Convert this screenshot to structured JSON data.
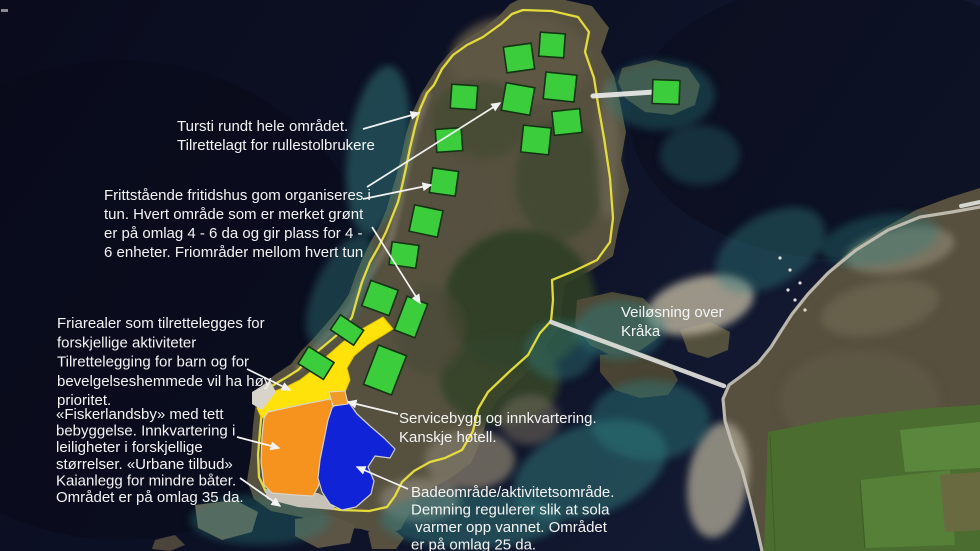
{
  "map_title": "Utviklingsplan – flyfoto med påtegninger",
  "colors": {
    "tun_green": "#3bcd3b",
    "tun_border": "#143214",
    "friareal_yellow": "#ffe20a",
    "friareal_yellow_border": "#e3c400",
    "fiskerlandsby_orange": "#f6921e",
    "badeomrade_blue": "#1023d6",
    "servicebygg_orange": "#f09a28",
    "zone_edge_gray": "#d9d4c8",
    "kai_gray": "#c6c2b8",
    "tursti_outline_yellow": "#ece23c",
    "annotation_white": "#f2f2f2"
  },
  "typography": {
    "font_size": 15,
    "default_line_height": 19
  },
  "labels": [
    {
      "id": "tursti",
      "x": 177,
      "y": 131,
      "lh": 19,
      "lines": [
        "Tursti rundt hele området.",
        "Tilrettelagt for rullestolbrukere"
      ]
    },
    {
      "id": "fritidshus",
      "x": 104,
      "y": 200,
      "lh": 19,
      "lines": [
        "Frittstående fritidshus gom organiseres i",
        "tun.  Hvert område som er merket grønt",
        "er på omlag 4 - 6  da og gir plass for 4 -",
        "6 enheter.  Friområder mellom hvert tun"
      ]
    },
    {
      "id": "friarealer",
      "x": 57,
      "y": 328,
      "lh": 19.3,
      "lines": [
        "Friarealer som tilrettelegges for",
        "forskjellige aktiviteter",
        "Tilrettelegging for barn og for",
        "bevelgelseshemmede vil ha høy",
        "prioritet."
      ]
    },
    {
      "id": "fiskerlandsby",
      "x": 56,
      "y": 419,
      "lh": 16.6,
      "lines": [
        "«Fiskerlandsby» med tett",
        "bebyggelse. Innkvartering i",
        "leiligheter i forskjellige",
        "størrelser.  «Urbane tilbud»",
        "Kaianlegg for mindre båter.",
        "Området er på omlag 35 da."
      ]
    },
    {
      "id": "servicebygg",
      "x": 399,
      "y": 423,
      "lh": 19,
      "lines": [
        "Servicebygg og innkvartering.",
        "Kanskje hotell."
      ]
    },
    {
      "id": "badeomrade",
      "x": 411,
      "y": 497,
      "lh": 17.5,
      "lines": [
        "Badeområde/aktivitetsområde.",
        "Demning regulerer slik at sola",
        " varmer opp vannet.  Området",
        "er på omlag 25 da."
      ]
    },
    {
      "id": "veilosning",
      "x": 621,
      "y": 317,
      "lh": 19,
      "lines": [
        "Veiløsning over",
        "Kråka"
      ]
    }
  ],
  "green_tun_areas": [
    {
      "cx": 519,
      "cy": 58,
      "w": 28,
      "h": 26,
      "rot": -8
    },
    {
      "cx": 552,
      "cy": 45,
      "w": 25,
      "h": 24,
      "rot": 4
    },
    {
      "cx": 560,
      "cy": 87,
      "w": 31,
      "h": 27,
      "rot": 6
    },
    {
      "cx": 518,
      "cy": 99,
      "w": 29,
      "h": 28,
      "rot": 10
    },
    {
      "cx": 464,
      "cy": 97,
      "w": 26,
      "h": 24,
      "rot": 4
    },
    {
      "cx": 567,
      "cy": 122,
      "w": 28,
      "h": 24,
      "rot": -6
    },
    {
      "cx": 536,
      "cy": 140,
      "w": 28,
      "h": 27,
      "rot": 6
    },
    {
      "cx": 449,
      "cy": 140,
      "w": 26,
      "h": 23,
      "rot": -4
    },
    {
      "cx": 444,
      "cy": 182,
      "w": 26,
      "h": 25,
      "rot": 8
    },
    {
      "cx": 426,
      "cy": 221,
      "w": 29,
      "h": 27,
      "rot": 12
    },
    {
      "cx": 404,
      "cy": 255,
      "w": 27,
      "h": 23,
      "rot": 8
    },
    {
      "cx": 666,
      "cy": 92,
      "w": 27,
      "h": 24,
      "rot": 2
    },
    {
      "cx": 380,
      "cy": 298,
      "w": 29,
      "h": 27,
      "rot": 20
    },
    {
      "cx": 347,
      "cy": 330,
      "w": 28,
      "h": 18,
      "rot": 34
    },
    {
      "cx": 316,
      "cy": 363,
      "w": 30,
      "h": 20,
      "rot": 32
    },
    {
      "cx": 411,
      "cy": 317,
      "w": 22,
      "h": 36,
      "rot": 21
    },
    {
      "cx": 385,
      "cy": 370,
      "w": 30,
      "h": 42,
      "rot": 21
    }
  ],
  "zones": [
    {
      "id": "friareal-yellow",
      "fill": "#ffe20a",
      "stroke": "#e3c400",
      "sw": 1,
      "points": "383,317 393,329 382,336 367,345 354,356 347,368 350,380 345,392 330,400 300,409 272,421 261,417 257,408 262,398 272,392 286,387 300,380 313,370 327,356 343,342 362,329"
    },
    {
      "id": "beach-wedge",
      "fill": "#d8d4c9",
      "stroke": "none",
      "sw": 0,
      "points": "252,392 270,381 276,392 262,410 252,404"
    },
    {
      "id": "kai-dock-gray",
      "fill": "#c6c2b8",
      "stroke": "none",
      "sw": 0,
      "points": "265,489 318,493 336,502 334,510 298,507 267,499"
    },
    {
      "id": "fiskerlandsby-orange",
      "fill": "#f6921e",
      "stroke": "#d9d4c8",
      "sw": 1.2,
      "points": "268,412 300,405 330,399 337,404 338,418 336,438 331,456 323,472 318,487 313,496 295,495 272,493 264,485 261,462 262,436 264,418"
    },
    {
      "id": "badeomrade-blue",
      "fill": "#1023d6",
      "stroke": "#cfcfcf",
      "sw": 1.2,
      "points": "336,404 347,400 357,414 370,426 384,438 395,449 390,458 375,456 368,467 374,481 371,494 356,507 342,510 330,504 322,492 318,478 320,460 324,440 328,420 332,408"
    },
    {
      "id": "servicebygg-orange-small",
      "fill": "#f09a28",
      "stroke": "#e0dcd2",
      "sw": 1,
      "points": "329,392 345,391 348,404 333,406"
    }
  ],
  "tursti_route": {
    "points": "523,10 552,11 578,17 589,32 585,52 594,78 598,104 604,138 610,178 613,218 610,242 597,260 574,271 552,280 553,300 551,321 540,333 528,355 509,372 488,392 478,409 473,431 462,450 445,458 430,462 414,471 402,482 395,496 387,507 369,511 341,510 315,506 282,501 266,492 259,477 258,455 260,431 262,409 258,400 265,391 275,384 287,377 298,370 308,360 319,350 331,340 344,329 352,317 357,299 362,282 370,262 378,248 386,232 392,217 398,202 402,186 406,168 410,148 415,127 420,109 427,93 434,85 442,69 453,55 467,45 483,37 501,24 512,14"
  },
  "link_lines": [
    {
      "id": "bridge-to-islet",
      "x1": 593,
      "y1": 96,
      "x2": 654,
      "y2": 92,
      "w": 5,
      "color": "#e6e6e3"
    },
    {
      "id": "proposed-road",
      "x1": 551,
      "y1": 322,
      "x2": 724,
      "y2": 386,
      "w": 4.5,
      "color": "#dcdcd8"
    },
    {
      "id": "edge-road-stub",
      "x1": 961,
      "y1": 206,
      "x2": 980,
      "y2": 202,
      "w": 4,
      "color": "#dcdcd8"
    }
  ],
  "arrows": [
    {
      "id": "tursti-arrow",
      "x1": 363,
      "y1": 129,
      "x2": 419,
      "y2": 113
    },
    {
      "id": "tun-arrow-upper",
      "x1": 367,
      "y1": 187,
      "x2": 500,
      "y2": 103
    },
    {
      "id": "tun-arrow-lower",
      "x1": 363,
      "y1": 199,
      "x2": 431,
      "y2": 185
    },
    {
      "id": "tun-arrow-south",
      "x1": 372,
      "y1": 227,
      "x2": 420,
      "y2": 303
    },
    {
      "id": "friareal-arrow",
      "x1": 247,
      "y1": 369,
      "x2": 290,
      "y2": 390
    },
    {
      "id": "fiskerlandsby-arrow",
      "x1": 237,
      "y1": 437,
      "x2": 279,
      "y2": 448
    },
    {
      "id": "kai-arrow",
      "x1": 240,
      "y1": 478,
      "x2": 280,
      "y2": 506
    },
    {
      "id": "servicebygg-arrow",
      "x1": 398,
      "y1": 414,
      "x2": 348,
      "y2": 402
    },
    {
      "id": "badeomrade-arrow",
      "x1": 408,
      "y1": 489,
      "x2": 357,
      "y2": 467
    }
  ]
}
